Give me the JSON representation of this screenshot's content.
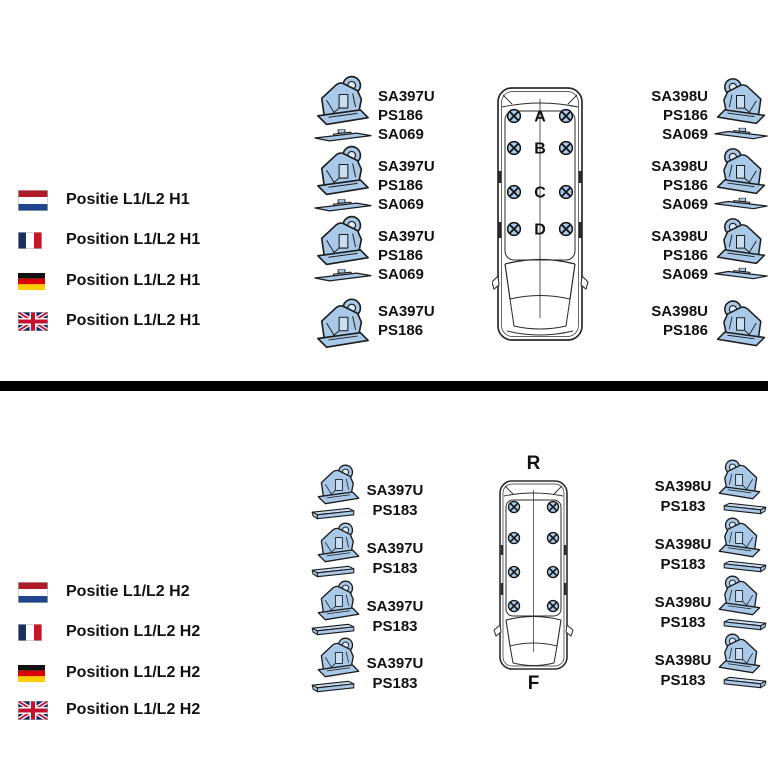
{
  "colors": {
    "part_fill": "#a9c9e9",
    "part_fill_light": "#c9def2",
    "part_fill_lighter": "#ddeaf7",
    "outline": "#1c1c1c",
    "van_line": "#2b2b2b",
    "divider": "#000000",
    "text": "#111111"
  },
  "top_section": {
    "legend": [
      {
        "flag": "netherlands",
        "label": "Positie L1/L2 H1"
      },
      {
        "flag": "france",
        "label": "Position L1/L2 H1"
      },
      {
        "flag": "germany",
        "label": "Position L1/L2 H1"
      },
      {
        "flag": "united-kingdom",
        "label": "Position L1/L2 H1"
      }
    ],
    "left_parts": [
      {
        "lines": [
          "SA397U",
          "PS186",
          "SA069"
        ]
      },
      {
        "lines": [
          "SA397U",
          "PS186",
          "SA069"
        ]
      },
      {
        "lines": [
          "SA397U",
          "PS186",
          "SA069"
        ]
      },
      {
        "lines": [
          "SA397U",
          "PS186"
        ]
      }
    ],
    "right_parts": [
      {
        "lines": [
          "SA398U",
          "PS186",
          "SA069"
        ]
      },
      {
        "lines": [
          "SA398U",
          "PS186",
          "SA069"
        ]
      },
      {
        "lines": [
          "SA398U",
          "PS186",
          "SA069"
        ]
      },
      {
        "lines": [
          "SA398U",
          "PS186"
        ]
      }
    ],
    "van": {
      "positions": [
        "A",
        "B",
        "C",
        "D"
      ],
      "mount_rows": 4,
      "mount_cols": 2
    }
  },
  "bottom_section": {
    "legend": [
      {
        "flag": "netherlands",
        "label": "Positie L1/L2 H2"
      },
      {
        "flag": "france",
        "label": "Position L1/L2 H2"
      },
      {
        "flag": "germany",
        "label": "Position L1/L2 H2"
      },
      {
        "flag": "united-kingdom",
        "label": "Position L1/L2 H2"
      }
    ],
    "left_parts": [
      {
        "lines": [
          "SA397U",
          "PS183"
        ]
      },
      {
        "lines": [
          "SA397U",
          "PS183"
        ]
      },
      {
        "lines": [
          "SA397U",
          "PS183"
        ]
      },
      {
        "lines": [
          "SA397U",
          "PS183"
        ]
      }
    ],
    "right_parts": [
      {
        "lines": [
          "SA398U",
          "PS183"
        ]
      },
      {
        "lines": [
          "SA398U",
          "PS183"
        ]
      },
      {
        "lines": [
          "SA398U",
          "PS183"
        ]
      },
      {
        "lines": [
          "SA398U",
          "PS183"
        ]
      }
    ],
    "van": {
      "rear_label": "R",
      "front_label": "F",
      "mount_rows": 4,
      "mount_cols": 2
    }
  }
}
